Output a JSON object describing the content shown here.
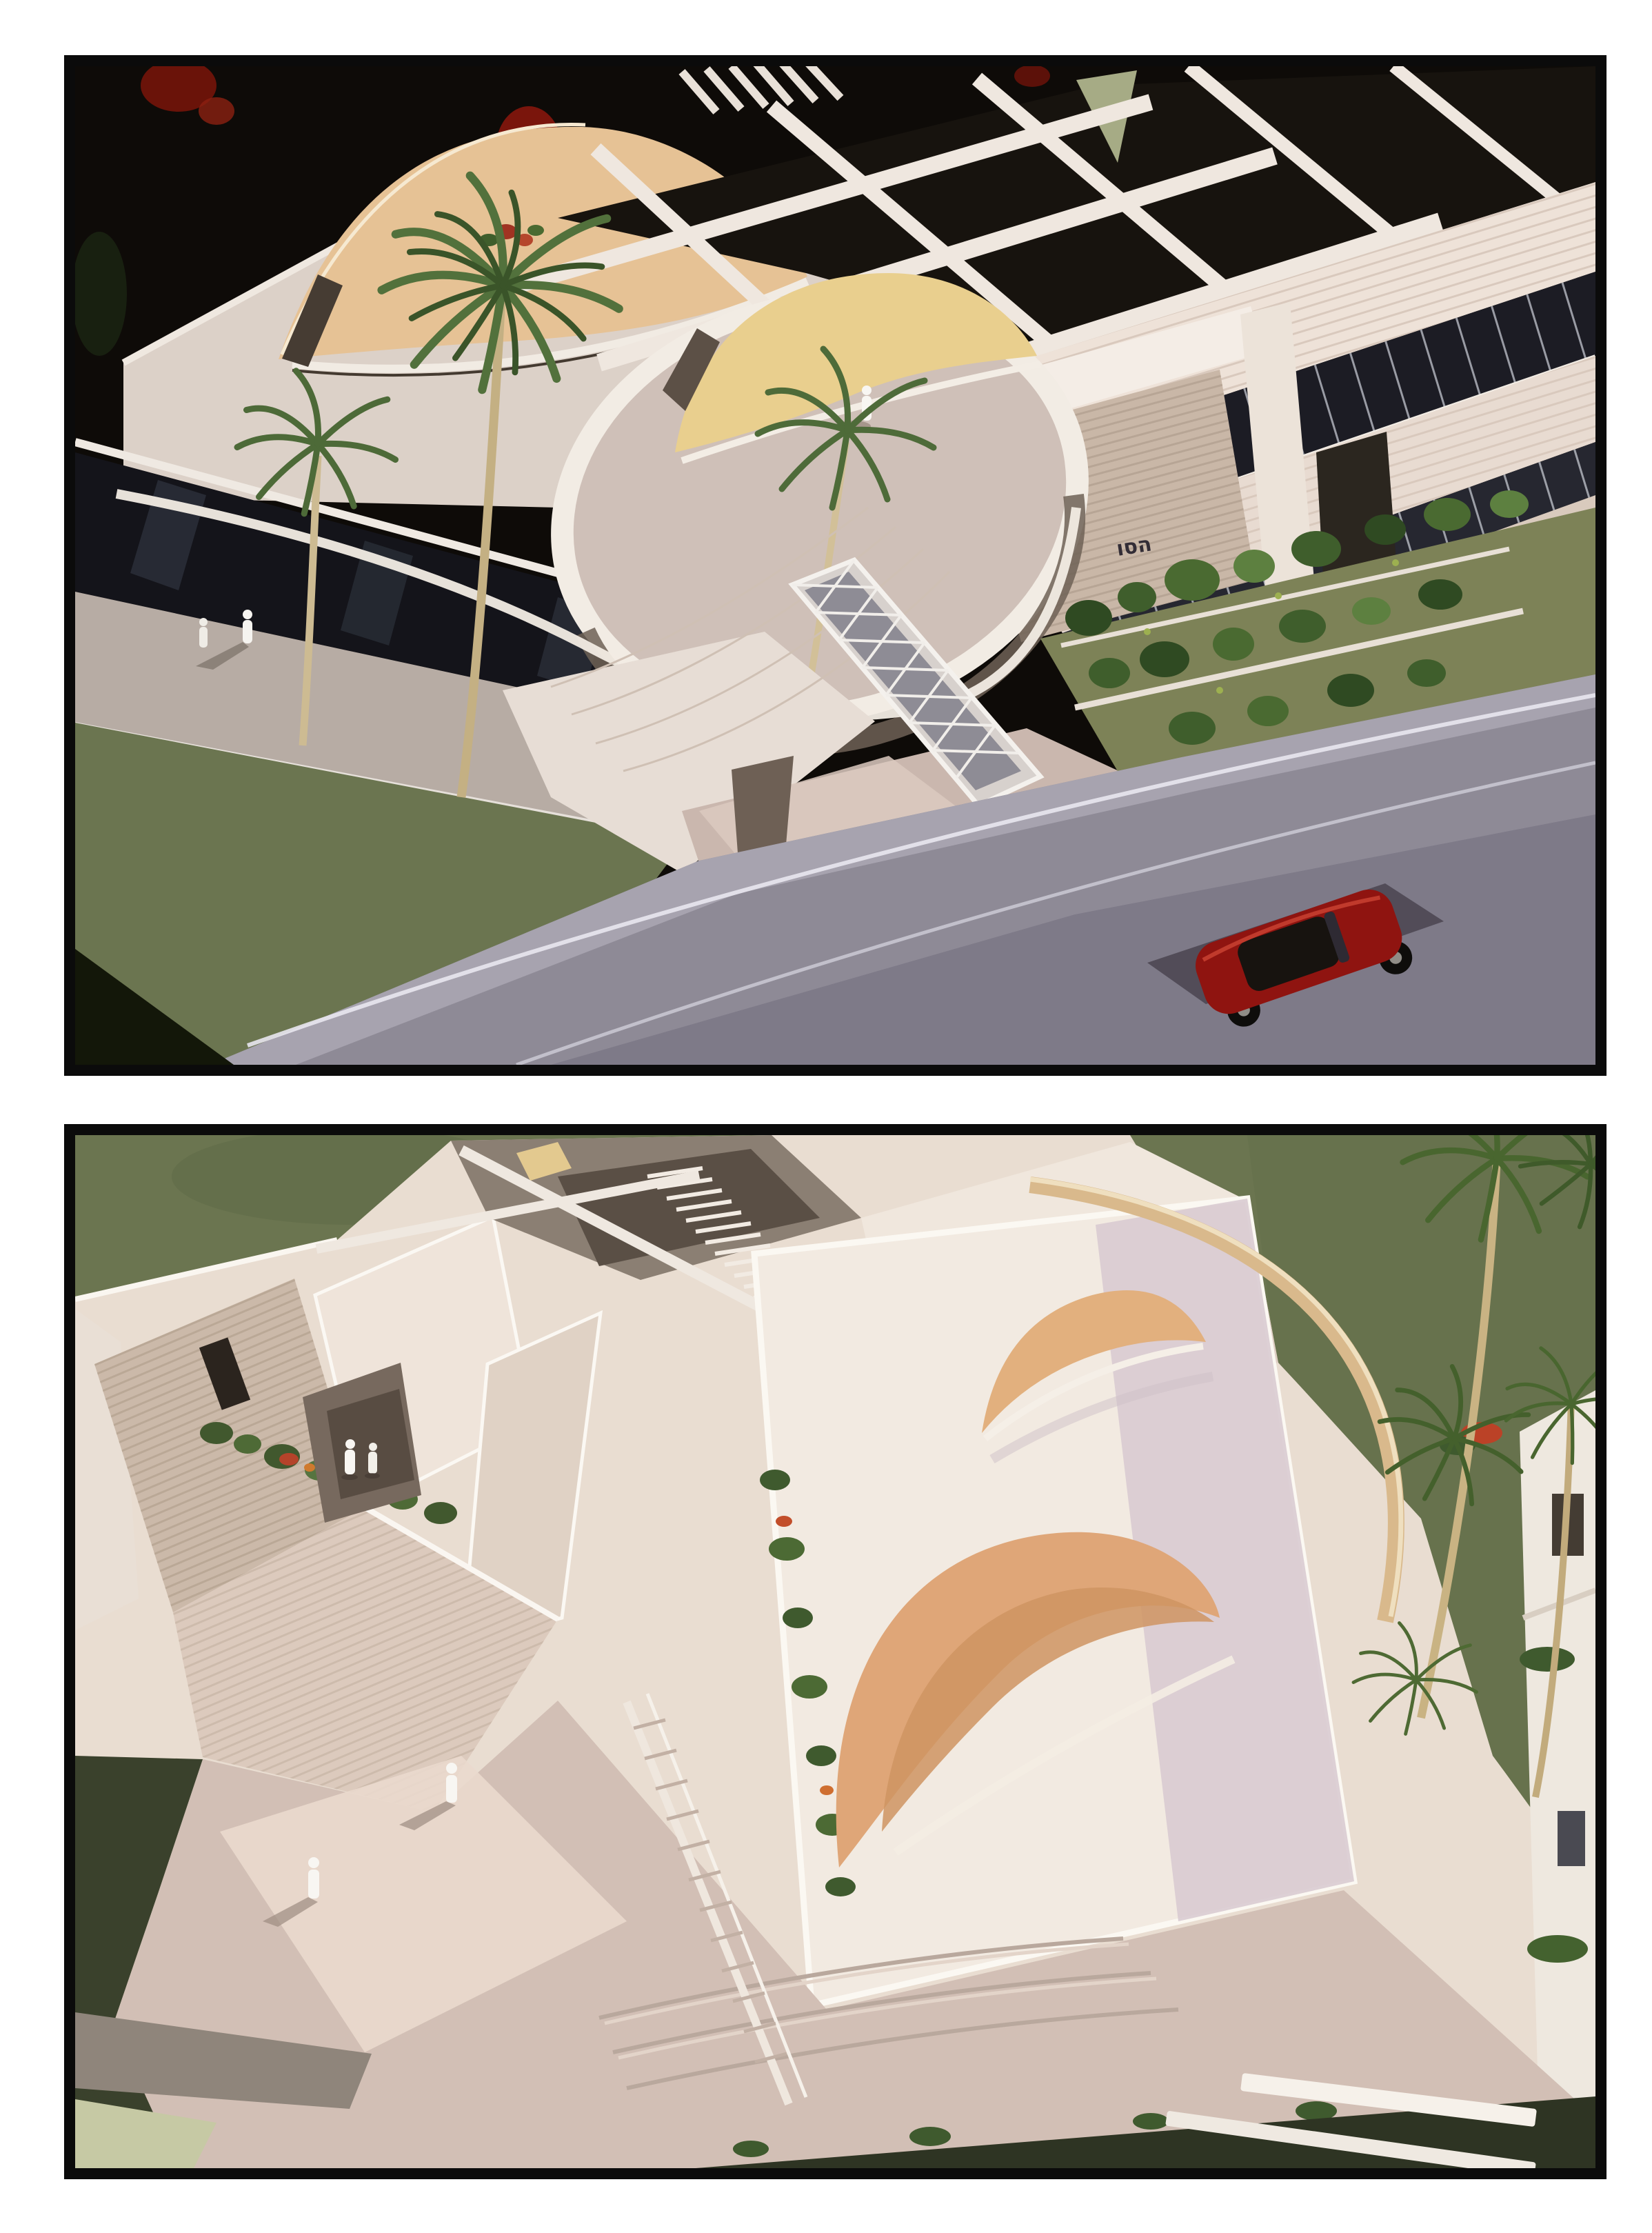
{
  "page": {
    "background": "#ffffff",
    "kind": "photo-board",
    "photo_count": 2
  },
  "palette": {
    "frame_black": "#0b0b0b",
    "backdrop_black": "#0e0b08",
    "flower_red": "#8c1a10",
    "model_white": "#efe7de",
    "model_cream": "#e3d6ca",
    "sail_beige": "#e6c295",
    "fin_yellow": "#e9cf8e",
    "shell_orange": "#dfa678",
    "crescent_tan": "#d9b98c",
    "stone_wall": "#c9b7a7",
    "glazing_dark": "#1c1c24",
    "lawn_green": "#6b7550",
    "shrub_green": "#3f5e2c",
    "palm_green": "#4e6b39",
    "palm_trunk": "#cdbb92",
    "road_gray": "#8e8a96",
    "car_red": "#8f1410",
    "plaza_pink": "#d2bfb5",
    "sage_wedge": "#c6c9a4",
    "figure_white": "#f7f5f1"
  },
  "photos": [
    {
      "name": "aerial-view-street",
      "signage_text": "הסו",
      "alt": "Aerial photo of a white architectural scale model: beige curved sail roof, round roof terrace with yellow curved wall and a miniature figure, palm-lined sidewalk with pedestrians, vaulted glass walkway canopy, terraced shrub garden, gray road with a red toy convertible; black backdrop with red flowers."
    },
    {
      "name": "aerial-view-courtyard",
      "alt": "Aerial photo of the same model seen from above: cream walls and roof decks, one large orange shell roof and a smaller orange crescent, a tan crescent canopy beam, planters with red flowers, diagonal stairs, a plaza with wide steps and miniature figures, palm trees and olive-green ground."
    }
  ]
}
